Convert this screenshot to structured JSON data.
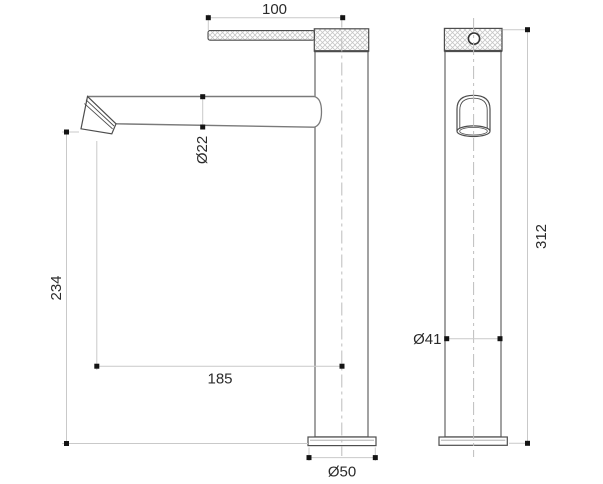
{
  "drawing": {
    "kind": "technical-dimension-drawing",
    "subject": "tall single-lever basin mixer tap, side view and front view"
  },
  "dimensions": {
    "handle_length": "100",
    "spout_diameter": "Ø22",
    "spout_height": "234",
    "spout_reach": "185",
    "base_diameter": "Ø50",
    "body_diameter": "Ø41",
    "total_height": "312"
  },
  "colors": {
    "background": "#ffffff",
    "line_dark": "#4d4d4d",
    "line_medium": "#7a7a7a",
    "dim_line": "#c9c9c9",
    "centerline": "#bdbdbd",
    "hatch": "#c6c6c6",
    "text": "#2b2b2b",
    "dot": "#141414"
  }
}
